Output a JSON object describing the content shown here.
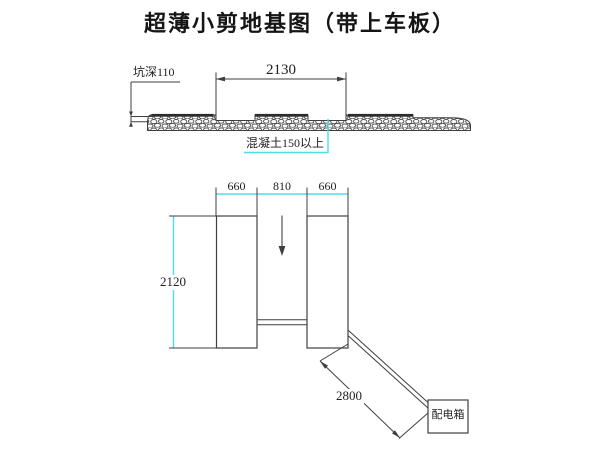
{
  "title": "超薄小剪地基图（带上车板）",
  "section_view": {
    "pit_depth": "坑深110",
    "pit_width": "2130",
    "concrete_note": "混凝土150以上"
  },
  "plan_view": {
    "left_width": "660",
    "center_width": "810",
    "right_width": "660",
    "platform_length": "2120",
    "cable_run": "2800",
    "power_box": "配电箱"
  },
  "colors": {
    "dimension_accent": "#4bdfe8",
    "line": "#3f3f3f"
  }
}
